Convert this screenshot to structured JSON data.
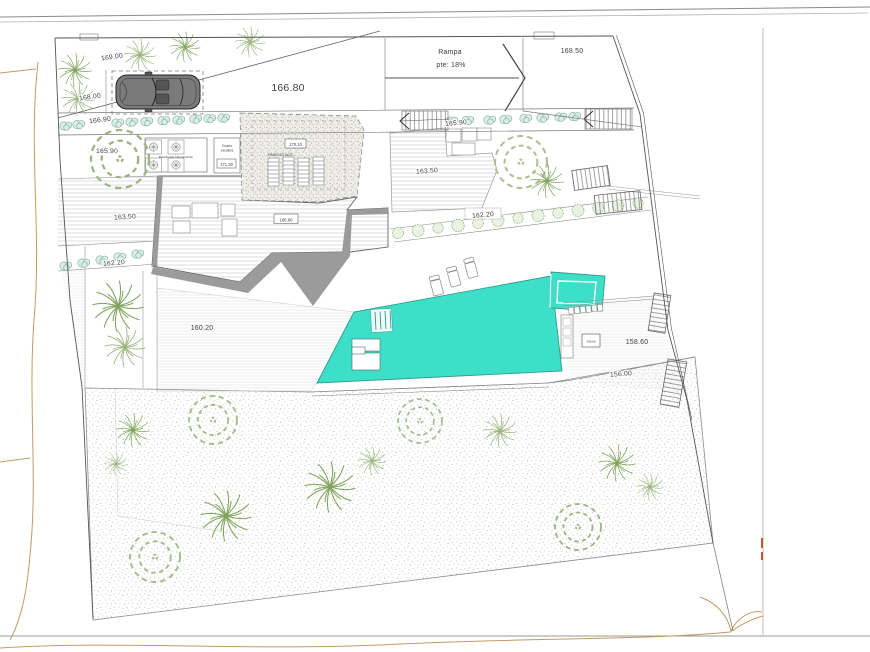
{
  "plan": {
    "elevations": {
      "strip_169": "169.00",
      "parking_168": "168.00",
      "driveway_166_80": "166.80",
      "upper_right_168_50": "168.50",
      "walkway_left_166_90": "166.90",
      "walkway_mid_165_90": "165.90",
      "tree_court_165_90": "165.90",
      "left_terrace_163_50": "163.50",
      "mid_terrace_163_50": "163.50",
      "left_band_162_20": "162.20",
      "hedge_band_162_20": "162.20",
      "lower_terrace_160_20": "160.20",
      "pool_deck_158_60": "158.60",
      "garden_edge_156_00": "156.00"
    },
    "ramp": {
      "label": "Rampa",
      "slope": "pte: 18%"
    },
    "house": {
      "roof_box_166_80": "166.80",
      "roof_box_170_10": "170.10",
      "roof_box_171_30": "171.30",
      "solar_panels_label": "PANELES ACS",
      "stair_room_line1": "Cuarto",
      "stair_room_line2": "escalera",
      "machinery_label": "Maquinaria Climatización"
    },
    "pool_area": {
      "equipment_box": "158.60"
    },
    "colors": {
      "pool": "#3EDFC8",
      "pool_edge": "#2E9C8C",
      "bush_fill": "#D8EEE7",
      "bush_stroke": "#7FA89D",
      "tree_green": "#7FA35C",
      "tree_light": "#A9BC90",
      "hatch_gray": "#CFCFCF",
      "shadow_gray": "#9B9B9B",
      "contour_tan": "#C49A62",
      "line_dark": "#555555"
    }
  }
}
